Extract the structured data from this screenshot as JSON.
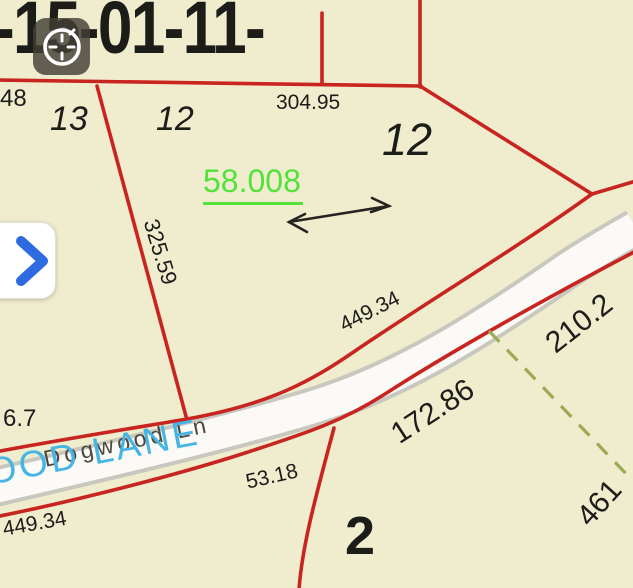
{
  "colors": {
    "background": "#f0edcf",
    "boundary_red": "#c82420",
    "area_green": "#52e23a",
    "road_label_cyan": "#45b4e6",
    "road_text_gray": "#4c473c",
    "dashed_olive": "#9cab52",
    "chevron_blue": "#2f6be0",
    "label_black": "#1c1c19",
    "road_fill": "#fbfaf6",
    "road_casing": "#c8c8bf",
    "icon_bg": "rgba(66,62,54,0.82)"
  },
  "labels": {
    "parcel_id": "-15-01-11-",
    "dim_48": "48",
    "lot_13": "13",
    "lot_12_small": "12",
    "dim_304_95": "304.95",
    "lot_12_large": "12",
    "area_58_008": "58.008",
    "dim_325_59": "325.59",
    "dim_449_34_road": "449.34",
    "dim_210_2": "210.2",
    "dim_172_86": "172.86",
    "dim_6_7": "6.7",
    "dim_53_18": "53.18",
    "dim_449_34_sw": "449.34",
    "lot_2": "2",
    "dim_461": "461",
    "road_name_overlay": "OOD LANE",
    "road_name": "Dogwood Ln"
  },
  "icons": {
    "clock": "clock-compass-icon",
    "expand": "chevron-right-icon"
  }
}
